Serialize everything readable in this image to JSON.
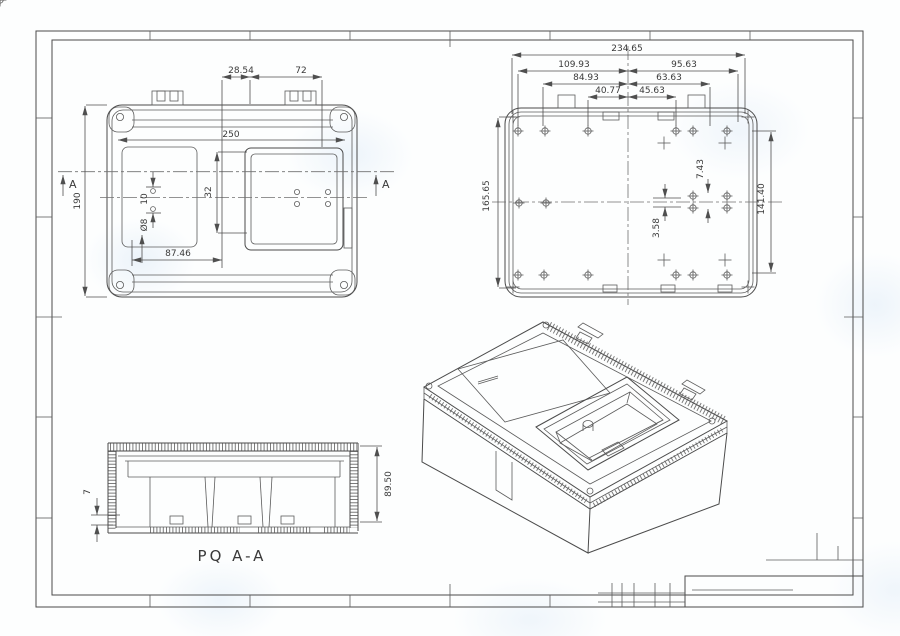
{
  "top_view": {
    "section_label": "A",
    "dim_width": "250",
    "dim_height": "190",
    "dim_tab_offset": "28.54",
    "dim_tab_span": "72",
    "dim_window_height": "32",
    "dim_hole_pitch": "10",
    "dim_hole_dia": "Ø8",
    "dim_slot_offset": "87.46"
  },
  "bottom_view": {
    "dim_overall": "234.65",
    "dim_left_outer": "109.93",
    "dim_right_outer": "95.63",
    "dim_left_mid": "84.93",
    "dim_right_mid": "63.63",
    "dim_left_inner": "40.77",
    "dim_right_inner": "45.63",
    "dim_height_left": "165.65",
    "dim_height_right": "141.40",
    "dim_hole_gap": "7.43",
    "dim_center_offset": "3.58"
  },
  "section_view": {
    "caption": "PQ  A-A",
    "dim_lip": "7",
    "dim_height": "89.50"
  }
}
